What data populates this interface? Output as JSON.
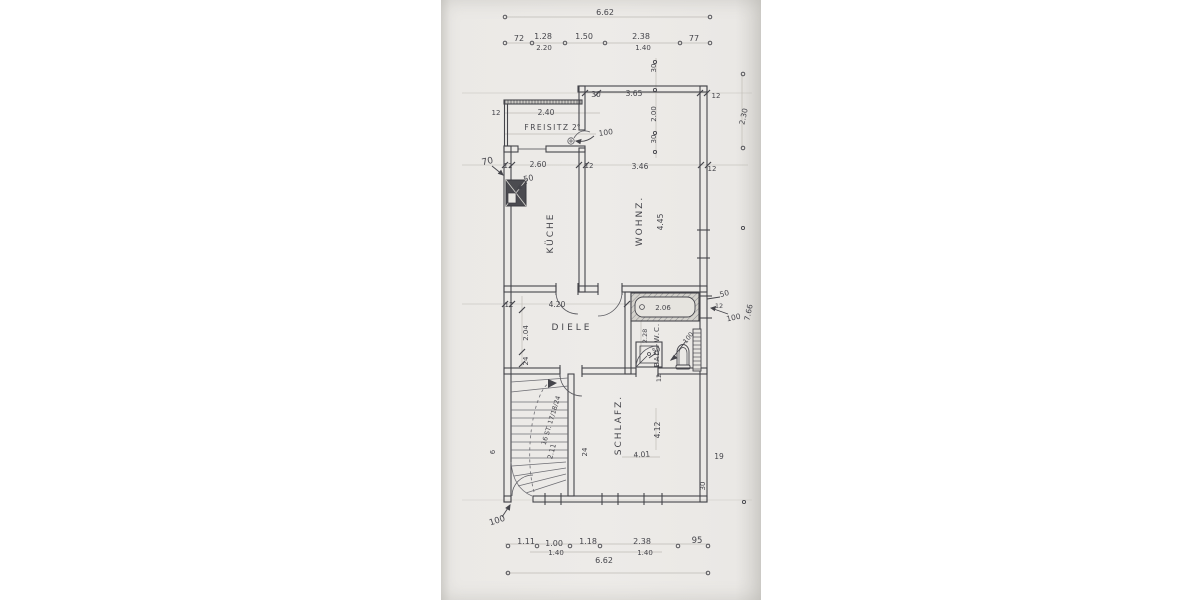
{
  "rooms": {
    "kueche": "KÜCHE",
    "wohnz": "WOHNZ.",
    "diele": "DIELE",
    "schlafz": "SCHLAFZ.",
    "freisitz": "FREISITZ",
    "bad": "BAD+W.C."
  },
  "top": {
    "overall": "6.62",
    "c": [
      "72",
      "1.28",
      "2.20",
      "1.50",
      "2.38",
      "1.40",
      "77"
    ]
  },
  "bottom": {
    "overall": "6.62",
    "c": [
      "1.11",
      "1.00",
      "1.40",
      "1.18",
      "2.38",
      "1.40",
      "95"
    ]
  },
  "upper": {
    "h": [
      "30",
      "3.65",
      "12"
    ],
    "v": [
      "30",
      "2.00",
      "30"
    ]
  },
  "mid": {
    "c": [
      "12",
      "2.60",
      "12",
      "3.46",
      "12"
    ]
  },
  "freisitz_dims": {
    "w": "2.40",
    "wall": "12",
    "deg": "2°",
    "door": "100"
  },
  "left": {
    "a": "70",
    "b": "50",
    "dieleh": "2.04",
    "sub": "24",
    "six": "6"
  },
  "right": {
    "v1": "2.30",
    "v2": "7.66",
    "off": "50",
    "wall": "12",
    "door": "100"
  },
  "wohnz_dims": {
    "h": "4.45"
  },
  "diele_dims": {
    "wall": "12",
    "w": "4.20"
  },
  "bath": {
    "tub": "2.06",
    "h": "2.28",
    "basin": "50",
    "door": "100",
    "wall": "12"
  },
  "stairs": {
    "note": "16 ST. 17/18/24",
    "w": "2.11",
    "wall": "24"
  },
  "schlafz_dims": {
    "h": "4.12",
    "w": "4.01",
    "r": "19",
    "b": "30"
  },
  "entrance": {
    "door": "100"
  },
  "ink_color": "#45454b",
  "paper_color": "#ebe9e6"
}
